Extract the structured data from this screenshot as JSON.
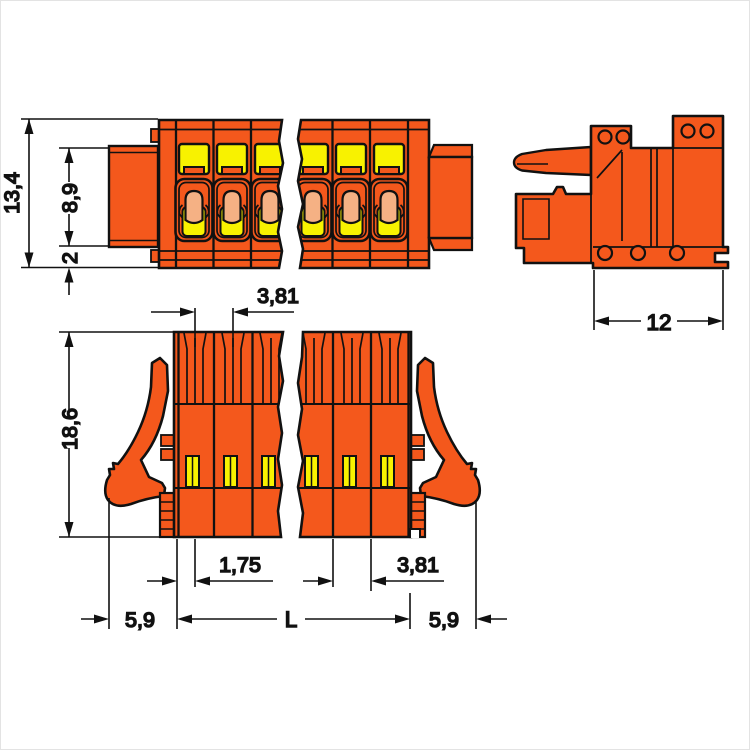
{
  "palette": {
    "housing_orange": "#f4581c",
    "actuator_yellow": "#f8f200",
    "conductor_entry_salmon": "#f5b184",
    "outline_black": "#111111",
    "background": "#ffffff"
  },
  "dimensions": {
    "front": {
      "overall_height": "13,4",
      "mating_height": "8,9",
      "flange_offset": "2"
    },
    "side": {
      "depth": "12"
    },
    "top": {
      "overall_depth": "18,6",
      "pole_pitch_top": "3,81",
      "first_pole_offset": "1,75",
      "pole_pitch_bottom": "3,81",
      "margin_left": "5,9",
      "length": "L",
      "margin_right": "5,9"
    }
  }
}
